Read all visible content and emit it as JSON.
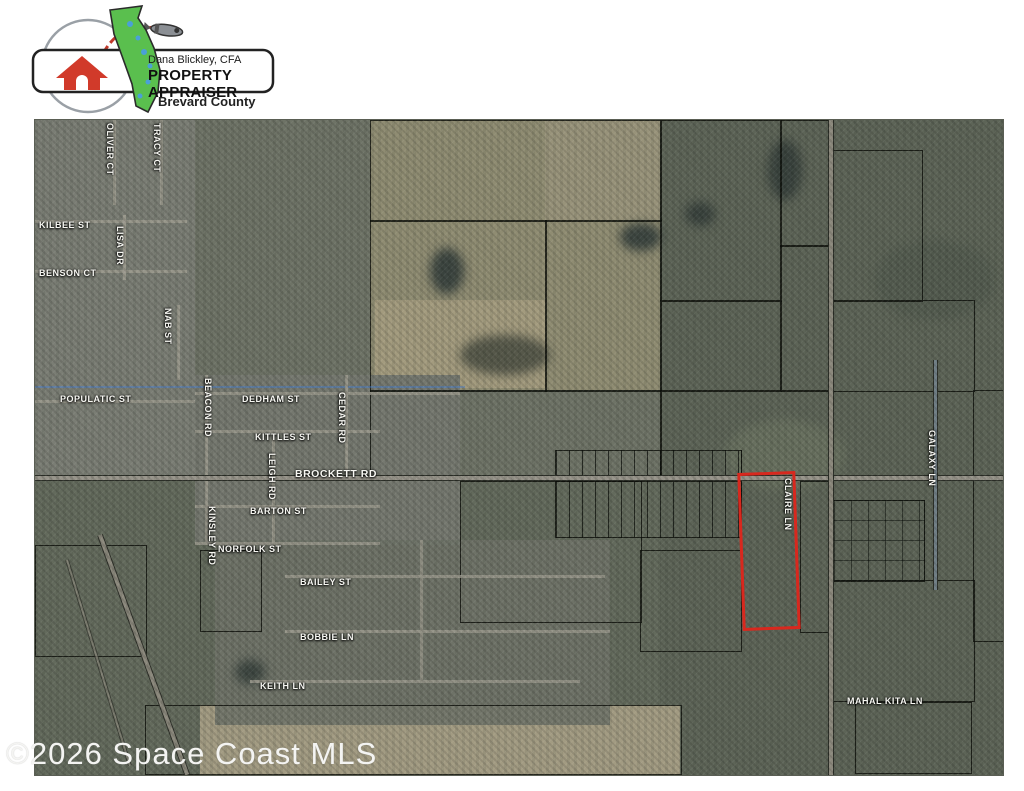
{
  "logo": {
    "owner": "Dana Blickley, CFA",
    "title": "PROPERTY APPRAISER",
    "county": "Brevard County",
    "icons": [
      "house-icon",
      "florida-map-icon",
      "rocket-icon",
      "orbit-icon"
    ],
    "colors": {
      "florida_green": "#5abf4e",
      "house_red": "#d13a2a",
      "trail_red": "#c0392b"
    }
  },
  "map": {
    "type": "aerial-parcel-map",
    "highlight_parcel": {
      "outline_color": "#d8281e"
    },
    "watermark": "©2026 Space Coast MLS",
    "streets": [
      {
        "label": "OLIVER CT"
      },
      {
        "label": "TRACY CT"
      },
      {
        "label": "KILBEE ST"
      },
      {
        "label": "BENSON CT"
      },
      {
        "label": "LISA DR"
      },
      {
        "label": "NAB ST"
      },
      {
        "label": "POPULATIC ST"
      },
      {
        "label": "DEDHAM ST"
      },
      {
        "label": "BEACON RD"
      },
      {
        "label": "CEDAR RD"
      },
      {
        "label": "KITTLES ST"
      },
      {
        "label": "LEIGH RD"
      },
      {
        "label": "BROCKETT RD"
      },
      {
        "label": "BARTON ST"
      },
      {
        "label": "KINSLEY RD"
      },
      {
        "label": "NORFOLK ST"
      },
      {
        "label": "BAILEY ST"
      },
      {
        "label": "BOBBIE LN"
      },
      {
        "label": "KEITH LN"
      },
      {
        "label": "CLAIRE LN"
      },
      {
        "label": "GALAXY LN"
      },
      {
        "label": "MAHAL KITA LN"
      }
    ]
  },
  "colors": {
    "map_base": "#6e7366",
    "label_text": "#f7f7f2",
    "red_outline": "#d8281e"
  }
}
